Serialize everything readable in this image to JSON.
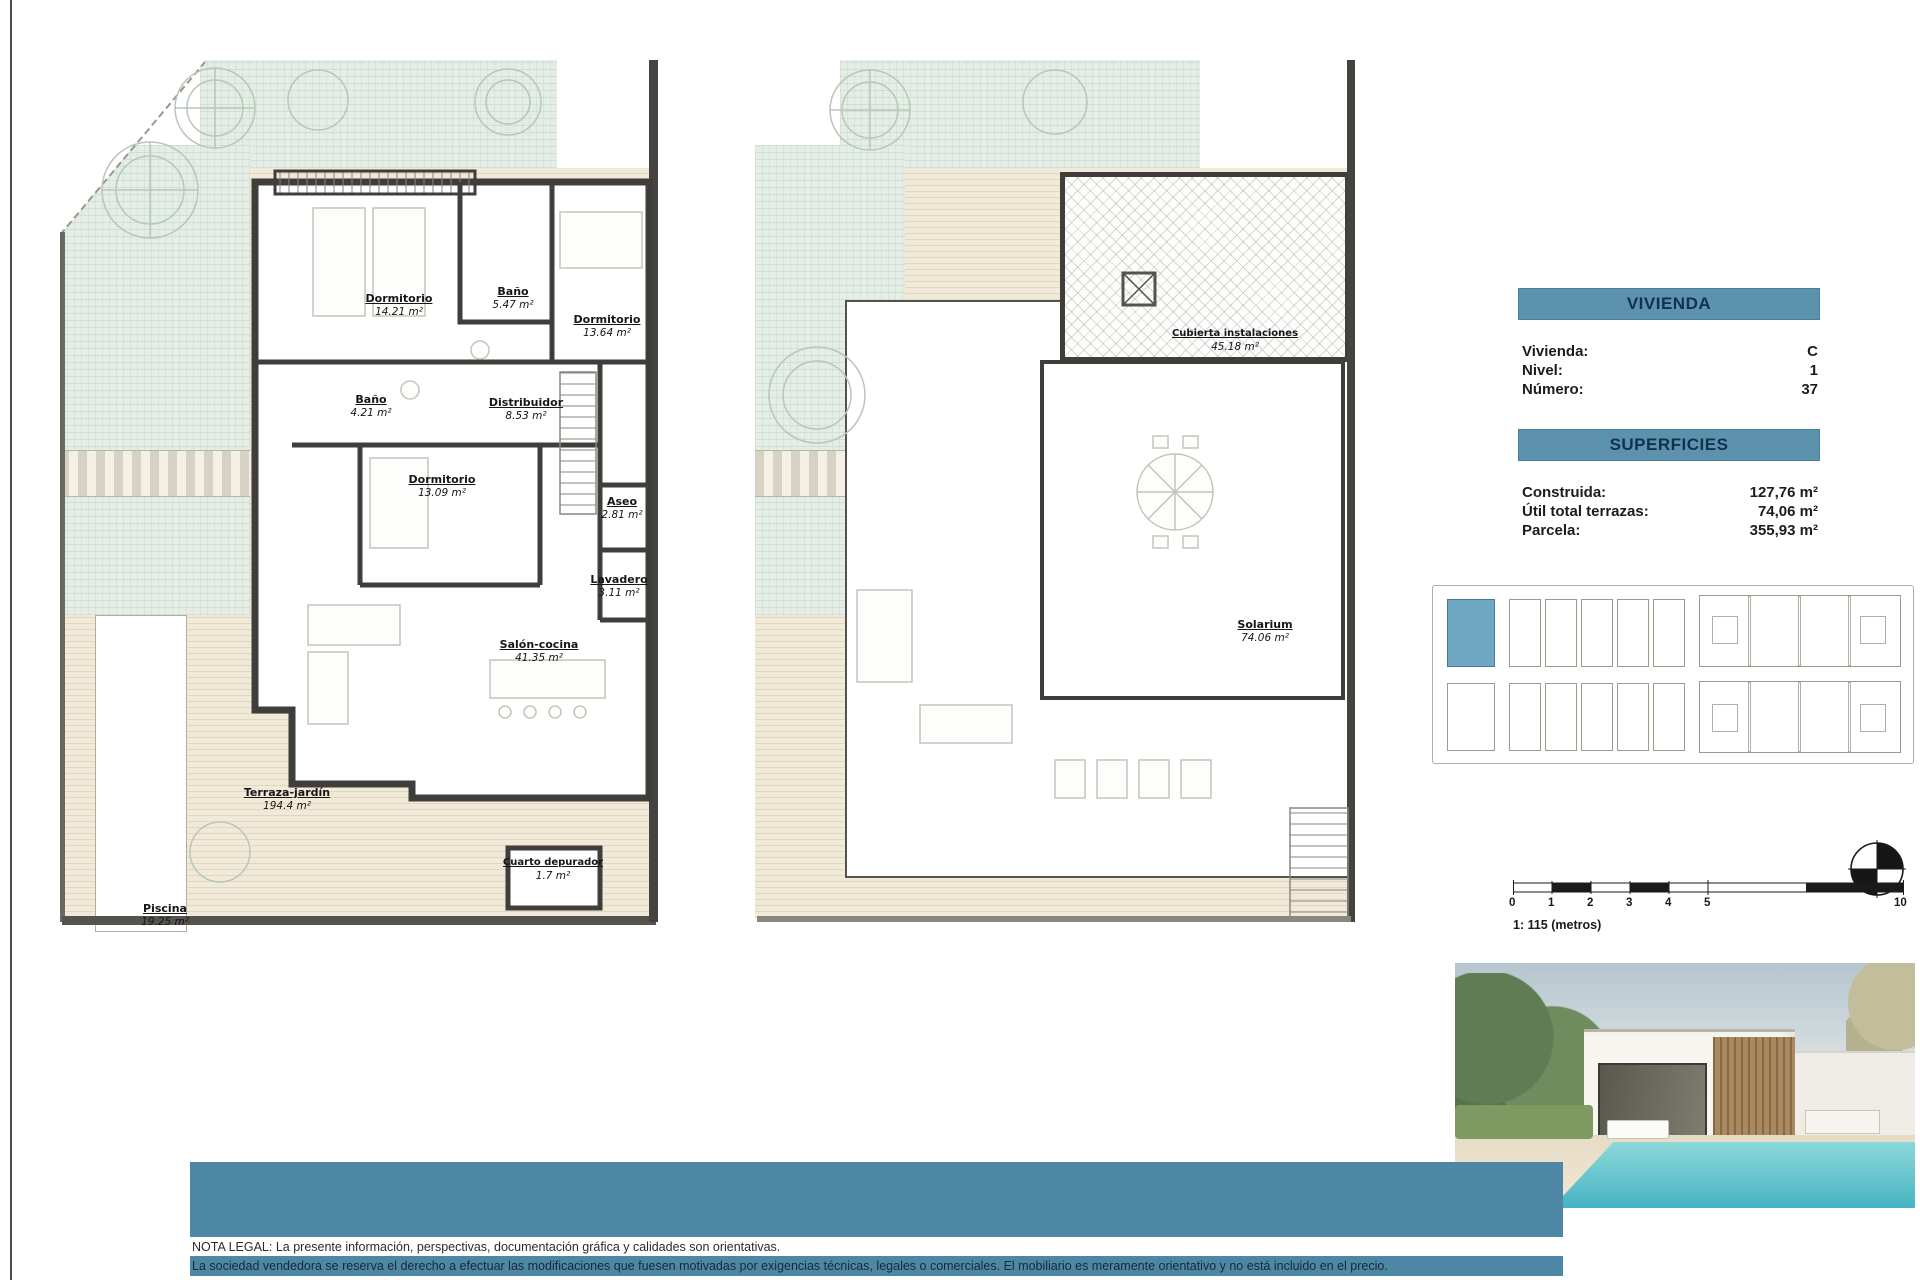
{
  "info": {
    "vivienda": {
      "header": "VIVIENDA",
      "rows": [
        {
          "label": "Vivienda:",
          "value": "C"
        },
        {
          "label": "Nivel:",
          "value": "1"
        },
        {
          "label": "Número:",
          "value": "37"
        }
      ]
    },
    "superficies": {
      "header": "SUPERFICIES",
      "rows": [
        {
          "label": "Construida:",
          "value": "127,76 m²"
        },
        {
          "label": "Útil total terrazas:",
          "value": "74,06 m²"
        },
        {
          "label": "Parcela:",
          "value": "355,93 m²"
        }
      ]
    }
  },
  "plan_ground": {
    "rooms": [
      {
        "name": "Dormitorio",
        "area": "14.21 m²"
      },
      {
        "name": "Baño",
        "area": "5.47 m²"
      },
      {
        "name": "Dormitorio",
        "area": "13.64 m²"
      },
      {
        "name": "Baño",
        "area": "4.21 m²"
      },
      {
        "name": "Distribuidor",
        "area": "8.53 m²"
      },
      {
        "name": "Dormitorio",
        "area": "13.09 m²"
      },
      {
        "name": "Aseo",
        "area": "2.81 m²"
      },
      {
        "name": "Lavadero",
        "area": "3.11 m²"
      },
      {
        "name": "Salón-cocina",
        "area": "41.35 m²"
      },
      {
        "name": "Cuarto depurador",
        "area": "1.7 m²"
      },
      {
        "name": "Terraza-jardín",
        "area": "194.4 m²"
      },
      {
        "name": "Piscina",
        "area": "19.25 m²"
      }
    ]
  },
  "plan_roof": {
    "rooms": [
      {
        "name": "Cubierta instalaciones",
        "area": "45.18 m²"
      },
      {
        "name": "Solarium",
        "area": "74.06 m²"
      }
    ]
  },
  "scale": {
    "ticks": [
      "0",
      "1",
      "2",
      "3",
      "4",
      "5",
      "10"
    ],
    "caption": "1: 115 (metros)"
  },
  "legal": {
    "line1": "NOTA LEGAL: La presente información, perspectivas, documentación gráfica y calidades son orientativas.",
    "line2": "La sociedad vendedora se reserva el derecho a efectuar las modificaciones que fuesen motivadas por exigencias técnicas, legales o comerciales. El mobiliario es meramente orientativo y no está incluido en el precio."
  },
  "colors": {
    "header_band": "#5d92ad",
    "header_text": "#13304f",
    "legal_band": "#4d87a5",
    "site_highlight": "#6fa7c2",
    "pool": "#46b4c2",
    "wall": "#3f3e3a"
  }
}
